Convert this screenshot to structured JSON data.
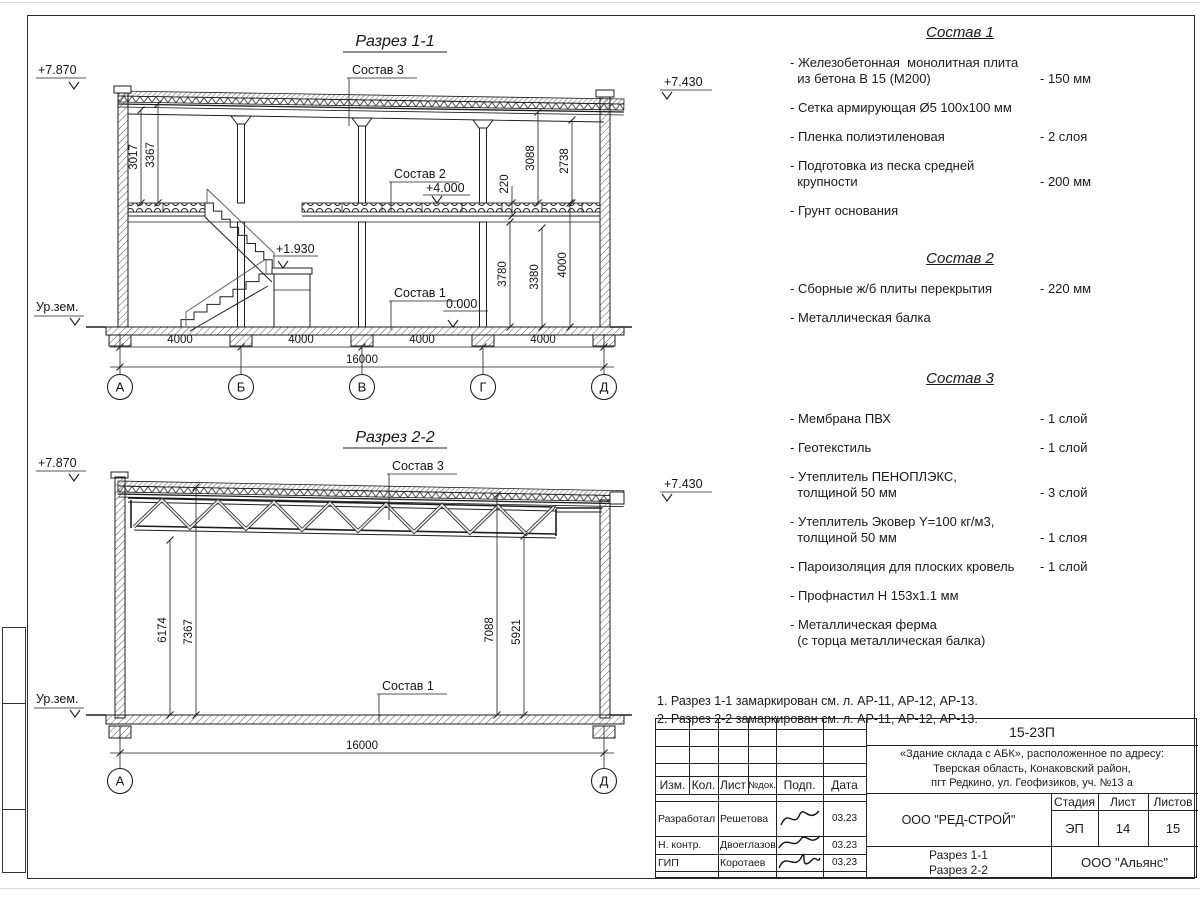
{
  "section1": {
    "title": "Разрез 1-1",
    "levels": {
      "left_top": "+7.870",
      "right_top": "+7.430",
      "floor0": "0.000",
      "floor1": "+4.000",
      "landing": "+1.930",
      "ground": "Ур.зем."
    },
    "leaders": {
      "c1": "Состав 1",
      "c2": "Состав 2",
      "c3": "Состав 3"
    },
    "dims": {
      "left": [
        "3017",
        "3367"
      ],
      "mid": [
        "220",
        "3088",
        "2738"
      ],
      "right": [
        "3780",
        "3380",
        "4000"
      ],
      "bottom": [
        "4000",
        "4000",
        "4000",
        "4000"
      ],
      "total": "16000"
    },
    "axes": [
      "А",
      "Б",
      "В",
      "Г",
      "Д"
    ]
  },
  "section2": {
    "title": "Разрез 2-2",
    "levels": {
      "left_top": "+7.870",
      "right_top": "+7.430",
      "ground": "Ур.зем."
    },
    "leaders": {
      "c1": "Состав 1",
      "c3": "Состав 3"
    },
    "dims": {
      "left": [
        "6174",
        "7367"
      ],
      "right": [
        "7088",
        "5921"
      ],
      "total": "16000"
    },
    "axes": [
      "А",
      "Д"
    ]
  },
  "compositions": [
    {
      "title": "Состав 1",
      "items": [
        {
          "text": "- Железобетонная  монолитная плита\n  из бетона В 15 (М200)",
          "value": "- 150 мм"
        },
        {
          "text": "- Сетка армирующая Ø5 100х100 мм",
          "value": ""
        },
        {
          "text": "- Пленка полиэтиленовая",
          "value": "- 2 слоя"
        },
        {
          "text": "- Подготовка из песка средней\n  крупности",
          "value": "- 200 мм"
        },
        {
          "text": "- Грунт основания",
          "value": ""
        }
      ]
    },
    {
      "title": "Состав 2",
      "items": [
        {
          "text": "- Сборные ж/б плиты перекрытия",
          "value": "- 220 мм"
        },
        {
          "text": "- Металлическая балка",
          "value": ""
        }
      ]
    },
    {
      "title": "Состав 3",
      "items": [
        {
          "text": "- Мембрана ПВХ",
          "value": "- 1 слой"
        },
        {
          "text": "- Геотекстиль",
          "value": "- 1 слой"
        },
        {
          "text": "- Утеплитель ПЕНОПЛЭКС,\n  толщиной 50 мм",
          "value": "- 3 слой"
        },
        {
          "text": "- Утеплитель Эковер Y=100 кг/м3,\n  толщиной 50 мм",
          "value": "- 1 слоя"
        },
        {
          "text": "- Пароизоляция для плоских кровель",
          "value": "- 1 слой"
        },
        {
          "text": "- Профнастил Н 153х1.1 мм",
          "value": ""
        },
        {
          "text": "- Металлическая ферма\n  (с торца металлическая балка)",
          "value": ""
        }
      ]
    }
  ],
  "notes": [
    "1. Разрез 1-1 замаркирован см. л. АР-11, АР-12, АР-13.",
    "2. Разрез 2-2 замаркирован см. л. АР-11, АР-12, АР-13."
  ],
  "title_block": {
    "code": "15-23П",
    "object_lines": "«Здание склада с АБК», расположенное по адресу:\nТверская область, Конаковский район,\nпгт Редкино, ул. Геофизиков, уч. №13 а",
    "org": "ООО \"РЕД-СТРОЙ\"",
    "sheet_title": "Разрез 1-1\nРазрез 2-2",
    "company": "ООО \"Альянс\"",
    "headers": {
      "izm": "Изм.",
      "kol": "Кол.",
      "list": "Лист",
      "ndok": "№док.",
      "podp": "Подп.",
      "data": "Дата",
      "stage": "Стадия",
      "sheet": "Лист",
      "sheets": "Листов"
    },
    "stage": "ЭП",
    "sheet_num": "14",
    "sheets_total": "15",
    "roles": [
      {
        "role": "Разработал",
        "name": "Решетова",
        "date": "03.23"
      },
      {
        "role": "Н. контр.",
        "name": "Двоеглазов",
        "date": "03.23"
      },
      {
        "role": "ГИП",
        "name": "Коротаев",
        "date": "03.23"
      }
    ]
  }
}
